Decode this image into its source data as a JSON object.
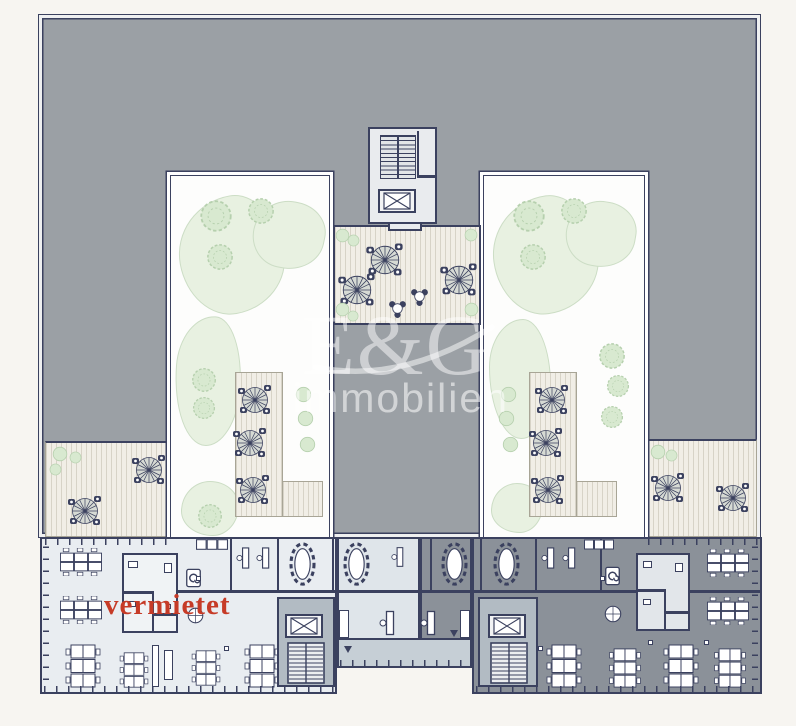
{
  "texts": {
    "status": "vermietet",
    "watermark_logo": "E&G",
    "watermark_sub": "immobilien"
  },
  "colors": {
    "background": "#f7f5f1",
    "roof": "#9ba0a5",
    "walls": "#3b415f",
    "courtyard": "#fdfdfc",
    "terrace": "#f1eee6",
    "terrace_line": "#d7d3c7",
    "office_light": "#e9edf1",
    "office_mid": "#dfe5ea",
    "office_dark": "#8b9199",
    "corridor": "#c6cfd6",
    "core": "#b2bbc3",
    "green_fill": "#e8f1e1",
    "green_line": "#ccddc5",
    "tree_fill": "#d8e9d0",
    "tree_line": "#b6d0ae",
    "status_red": "#c63b27",
    "watermark": "#ffffff"
  },
  "icons": {
    "umbrella_table": "umbrella-table-icon",
    "bistro_table": "bistro-table-icon",
    "tree": "tree-icon",
    "bush": "bush-icon",
    "oval_meeting_table": "oval-meeting-table-icon",
    "elevator": "elevator-icon",
    "stairs": "stairs-icon",
    "spiral_stairs": "spiral-stairs-icon",
    "bench_desks": "bench-desks-icon",
    "single_desk": "single-desk-icon",
    "round_table": "round-table-icon",
    "kitchen_units": "kitchen-units-icon",
    "door_swing": "door-swing-icon"
  }
}
